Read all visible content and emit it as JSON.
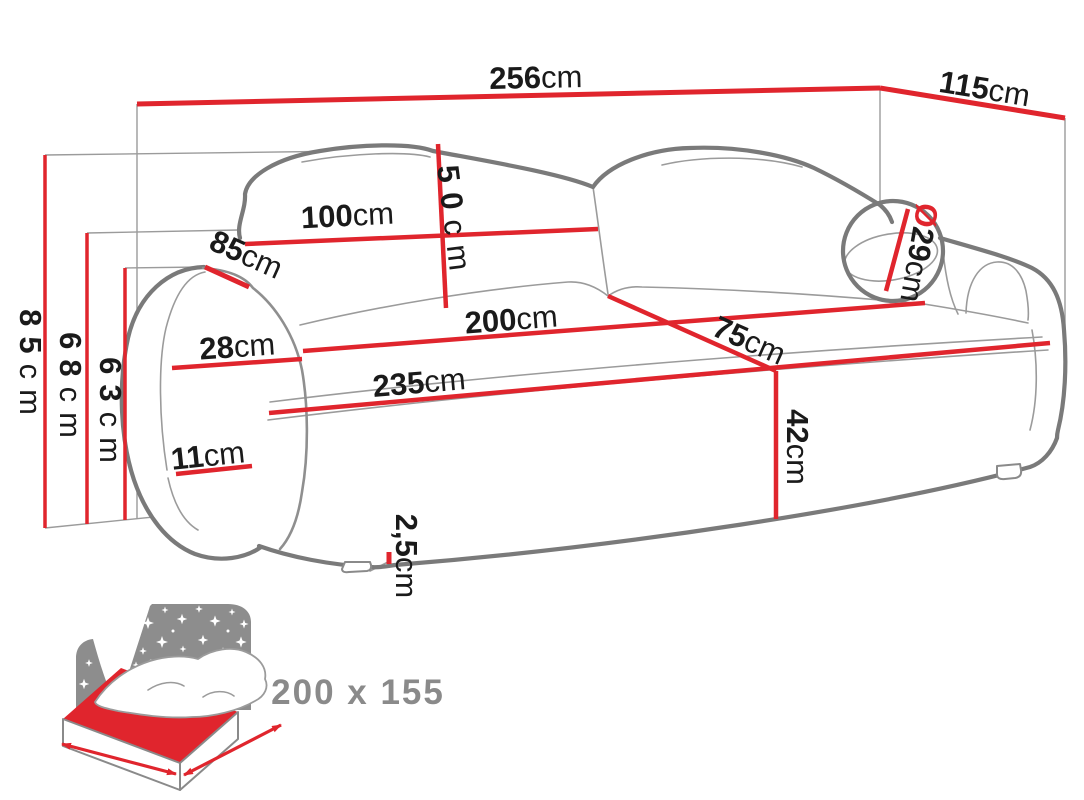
{
  "dims": {
    "w256": {
      "value": "256",
      "unit": "cm"
    },
    "d115": {
      "value": "115",
      "unit": "cm"
    },
    "h85": {
      "value": "85",
      "unit": "cm"
    },
    "h68": {
      "value": "68",
      "unit": "cm"
    },
    "h63": {
      "value": "63",
      "unit": "cm"
    },
    "b50": {
      "value": "50",
      "unit": "cm"
    },
    "w100": {
      "value": "100",
      "unit": "cm"
    },
    "a85": {
      "value": "85",
      "unit": "cm"
    },
    "a28": {
      "value": "28",
      "unit": "cm"
    },
    "s200": {
      "value": "200",
      "unit": "cm"
    },
    "s75": {
      "value": "75",
      "unit": "cm"
    },
    "f235": {
      "value": "235",
      "unit": "cm"
    },
    "h42": {
      "value": "42",
      "unit": "cm"
    },
    "c11": {
      "value": "11",
      "unit": "cm"
    },
    "dia29": {
      "symbol": "Ø",
      "value": "29",
      "unit": "cm"
    },
    "leg25": {
      "value": "2,5",
      "unit": "cm"
    }
  },
  "bed": {
    "size_label": "200 x 155"
  },
  "colors": {
    "dimension_red": "#e0252d",
    "sofa_outline_gray": "#7a7a7a",
    "detail_gray": "#9b9b9b",
    "label_black": "#1a1a1a",
    "icon_panel_gray": "#8d8d8d",
    "icon_text_gray": "#8a8a8a",
    "background": "#ffffff"
  }
}
